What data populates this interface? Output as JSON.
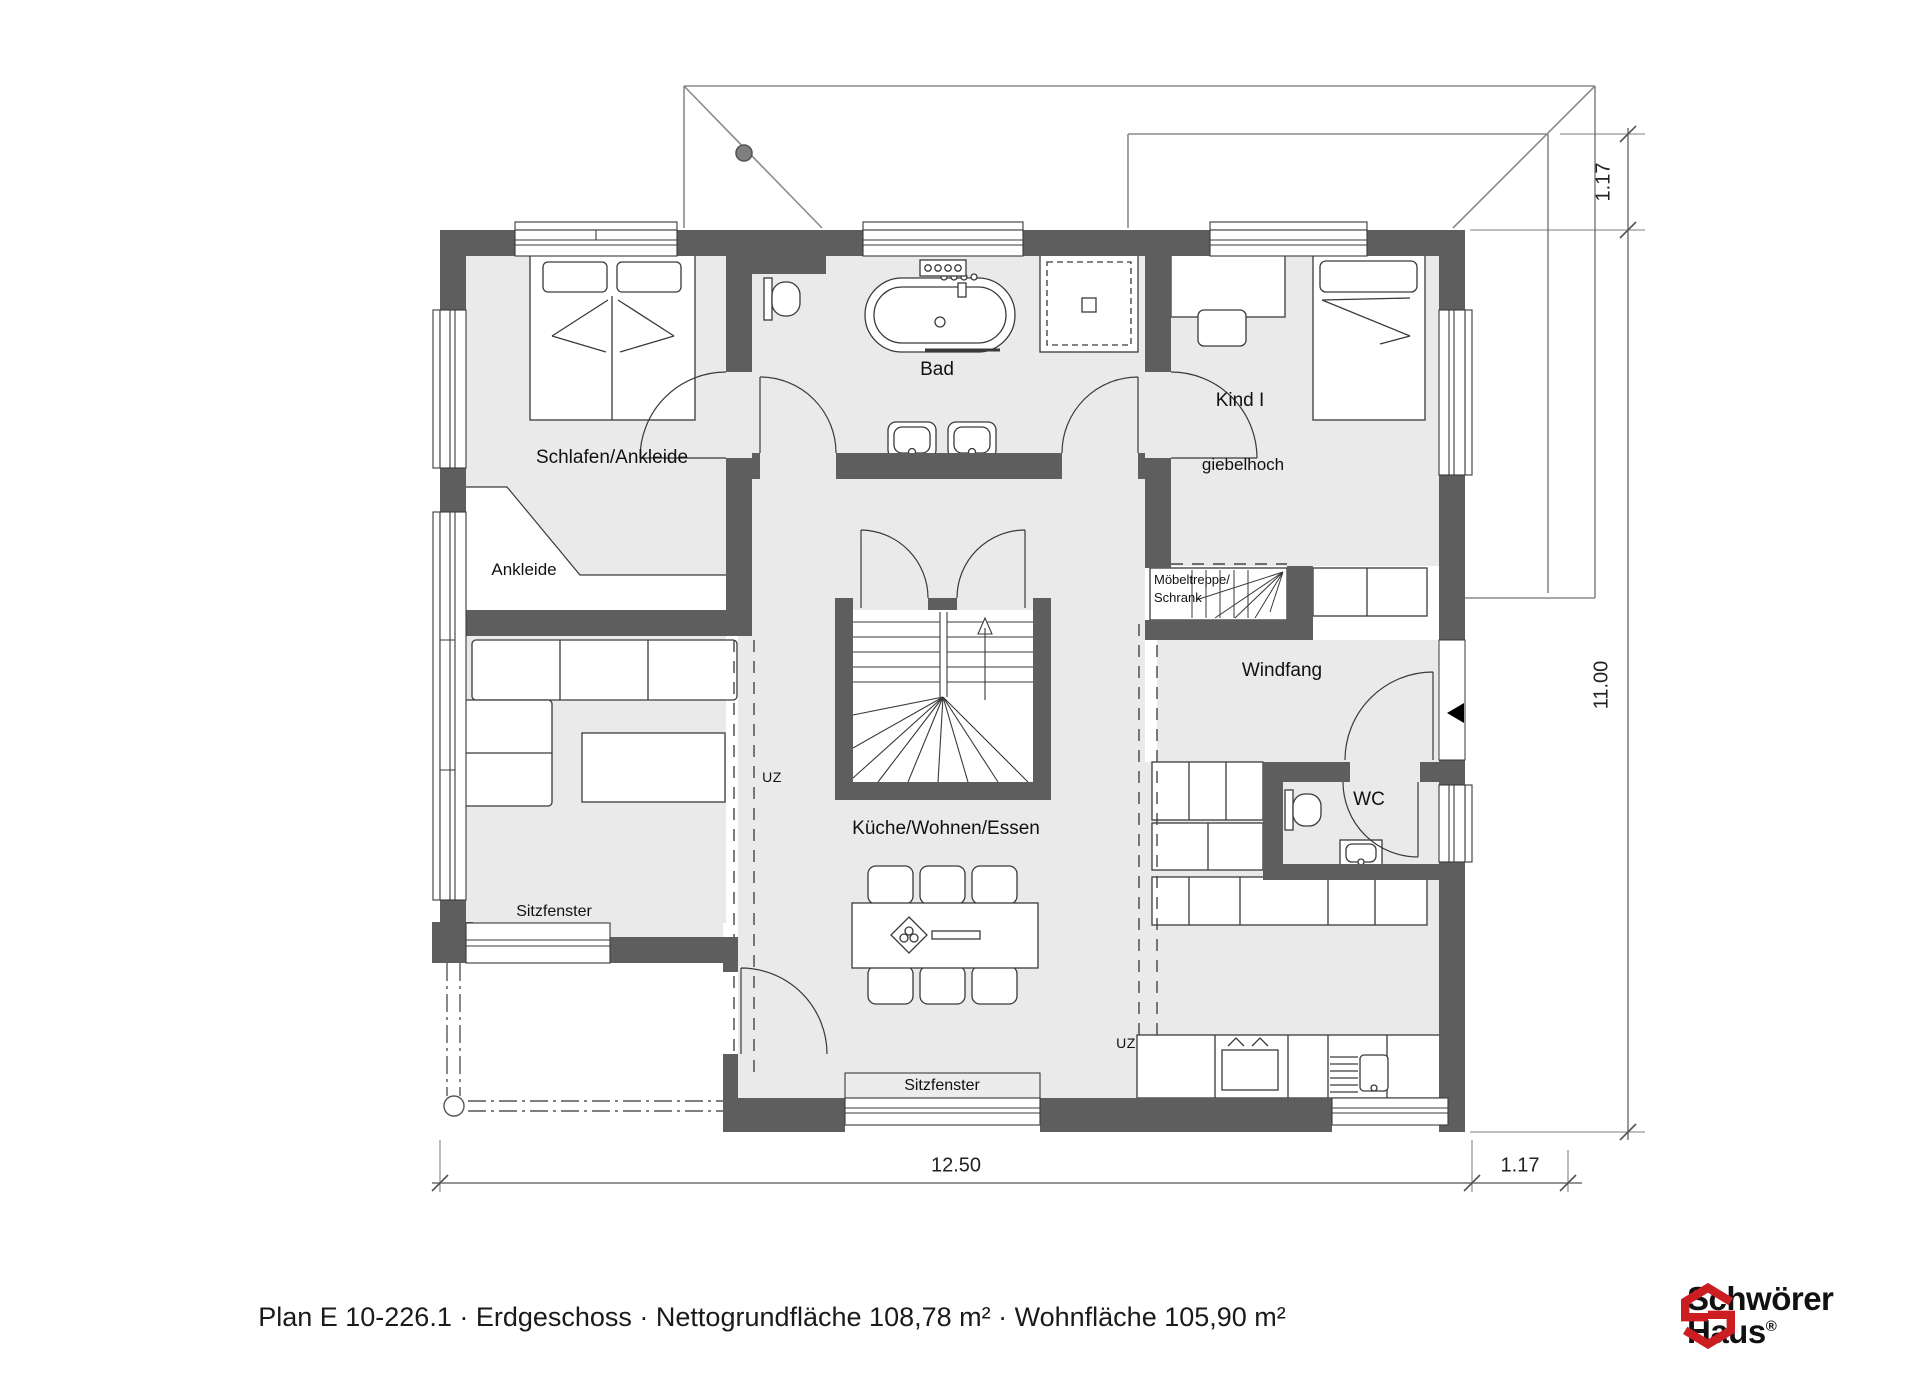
{
  "plan": {
    "rooms": {
      "schlafen": "Schlafen/Ankleide",
      "ankleide": "Ankleide",
      "bad": "Bad",
      "kind": "Kind I",
      "kind_note": "giebelhoch",
      "moebeltreppe_line1": "Möbeltreppe/",
      "moebeltreppe_line2": "Schrank",
      "windfang": "Windfang",
      "wc": "WC",
      "kueche": "Küche/Wohnen/Essen",
      "sitzfenster_left": "Sitzfenster",
      "sitzfenster_bottom": "Sitzfenster",
      "uz_living": "UZ",
      "uz_kitchen": "UZ"
    },
    "dimensions": {
      "right_overhang": "1.17",
      "right_height": "11.00",
      "bottom_width": "12.50",
      "bottom_overhang": "1.17"
    },
    "footer": {
      "title": "Plan E 10-226.1 · Erdgeschoss · Nettogrundfläche 108,78 m² · Wohnfläche 105,90 m²"
    },
    "logo": {
      "brand_line1": "Schwörer",
      "brand_line2": "Haus",
      "registered": "®",
      "icon": "schwoerer-hex-s-icon",
      "accent_color": "#cc1d23"
    },
    "colors": {
      "wall": "#5e5e5e",
      "floor": "#eaeaea",
      "line": "#3a3a3a"
    }
  }
}
